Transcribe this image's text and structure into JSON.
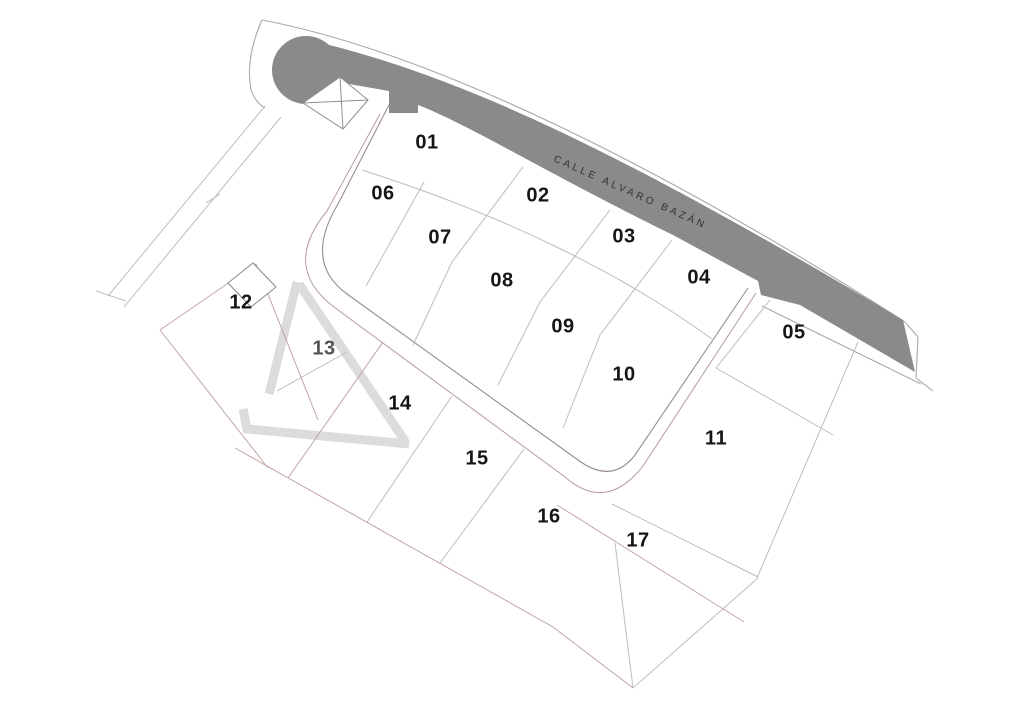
{
  "map": {
    "street_name": "CALLE ALVARO BAZÁN",
    "lots": [
      {
        "id": "01",
        "x": 427,
        "y": 143,
        "color": "#161616"
      },
      {
        "id": "02",
        "x": 538,
        "y": 196,
        "color": "#161616"
      },
      {
        "id": "03",
        "x": 624,
        "y": 237,
        "color": "#161616"
      },
      {
        "id": "04",
        "x": 699,
        "y": 278,
        "color": "#161616"
      },
      {
        "id": "05",
        "x": 794,
        "y": 333,
        "color": "#161616"
      },
      {
        "id": "06",
        "x": 383,
        "y": 194,
        "color": "#161616"
      },
      {
        "id": "07",
        "x": 440,
        "y": 238,
        "color": "#161616"
      },
      {
        "id": "08",
        "x": 502,
        "y": 281,
        "color": "#161616"
      },
      {
        "id": "09",
        "x": 563,
        "y": 327,
        "color": "#161616"
      },
      {
        "id": "10",
        "x": 624,
        "y": 375,
        "color": "#161616"
      },
      {
        "id": "11",
        "x": 716,
        "y": 439,
        "color": "#161616"
      },
      {
        "id": "12",
        "x": 241,
        "y": 303,
        "color": "#161616"
      },
      {
        "id": "13",
        "x": 324,
        "y": 349,
        "color": "#555555"
      },
      {
        "id": "14",
        "x": 400,
        "y": 404,
        "color": "#161616"
      },
      {
        "id": "15",
        "x": 477,
        "y": 459,
        "color": "#161616"
      },
      {
        "id": "16",
        "x": 549,
        "y": 517,
        "color": "#161616"
      },
      {
        "id": "17",
        "x": 638,
        "y": 541,
        "color": "#161616"
      }
    ],
    "symbols": {
      "crossed_box": "utility-structure",
      "small_rect": "building-structure"
    },
    "colors": {
      "street_fill": "#8a8a8a",
      "street_label": "#303030",
      "outline": "#a8a8a8",
      "lane_inner": "#9a8d8d",
      "lane_outer": "#b79a9a",
      "parcel_line": "#bdbdbd",
      "boundary_red": "#c2a4a4",
      "watermark": "#dcdcdc",
      "symbol_stroke": "#8f8f8f"
    }
  }
}
